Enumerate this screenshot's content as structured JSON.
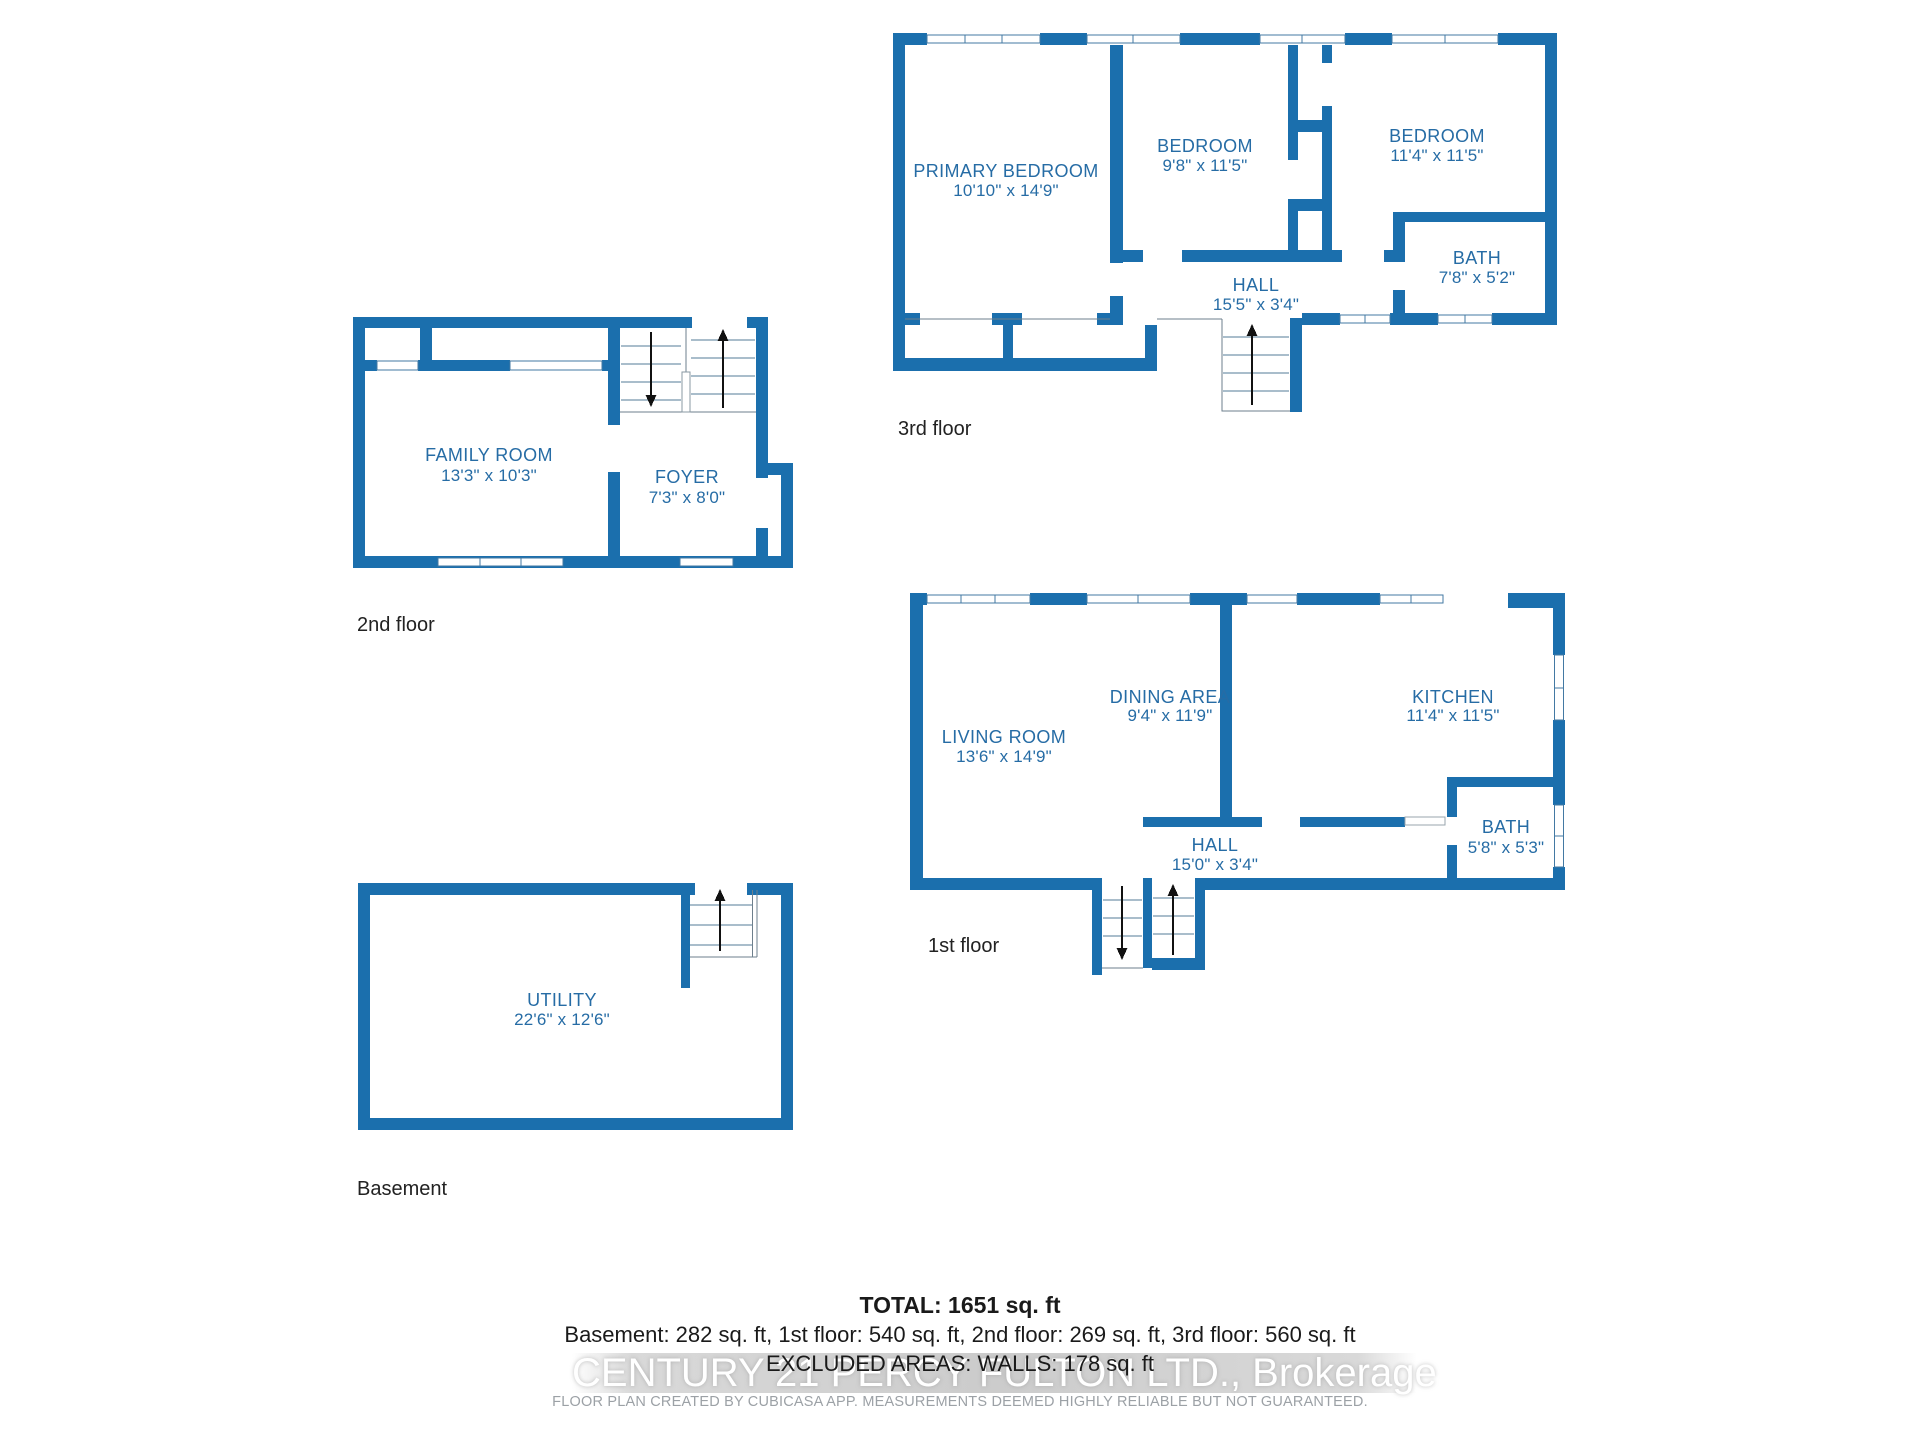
{
  "colors": {
    "wall": "#1B6FAD",
    "room_label": "#266CA5",
    "floor_label": "#222222",
    "window_line": "#4379A3",
    "step_line": "#A9BDCB",
    "edge_line": "#6E7F8C",
    "arrow": "#111111",
    "summary_text": "#1A1A1A",
    "watermark_text": "#FFFFFF",
    "disclaimer_text": "#9CA1A6"
  },
  "floors": [
    {
      "label": "3rd floor",
      "rooms": [
        {
          "name": "PRIMARY BEDROOM",
          "dims": "10'10\" x 14'9\""
        },
        {
          "name": "BEDROOM",
          "dims": "9'8\" x 11'5\""
        },
        {
          "name": "BEDROOM",
          "dims": "11'4\" x 11'5\""
        },
        {
          "name": "BATH",
          "dims": "7'8\" x 5'2\""
        },
        {
          "name": "HALL",
          "dims": "15'5\" x 3'4\""
        }
      ]
    },
    {
      "label": "2nd floor",
      "rooms": [
        {
          "name": "FAMILY ROOM",
          "dims": "13'3\" x 10'3\""
        },
        {
          "name": "FOYER",
          "dims": "7'3\" x 8'0\""
        }
      ]
    },
    {
      "label": "1st floor",
      "rooms": [
        {
          "name": "LIVING ROOM",
          "dims": "13'6\" x 14'9\""
        },
        {
          "name": "DINING AREA",
          "dims": "9'4\" x 11'9\""
        },
        {
          "name": "KITCHEN",
          "dims": "11'4\" x 11'5\""
        },
        {
          "name": "BATH",
          "dims": "5'8\" x 5'3\""
        },
        {
          "name": "HALL",
          "dims": "15'0\" x 3'4\""
        }
      ]
    },
    {
      "label": "Basement",
      "rooms": [
        {
          "name": "UTILITY",
          "dims": "22'6\" x 12'6\""
        }
      ]
    }
  ],
  "summary": {
    "total": "TOTAL: 1651 sq. ft",
    "breakdown": "Basement: 282 sq. ft, 1st floor: 540 sq. ft, 2nd floor: 269 sq. ft, 3rd floor: 560 sq. ft",
    "excluded": "EXCLUDED AREAS: WALLS: 178 sq. ft",
    "watermark": "CENTURY 21 PERCY FULTON LTD., Brokerage",
    "disclaimer": "FLOOR PLAN CREATED BY CUBICASA APP. MEASUREMENTS DEEMED HIGHLY RELIABLE BUT NOT GUARANTEED."
  }
}
